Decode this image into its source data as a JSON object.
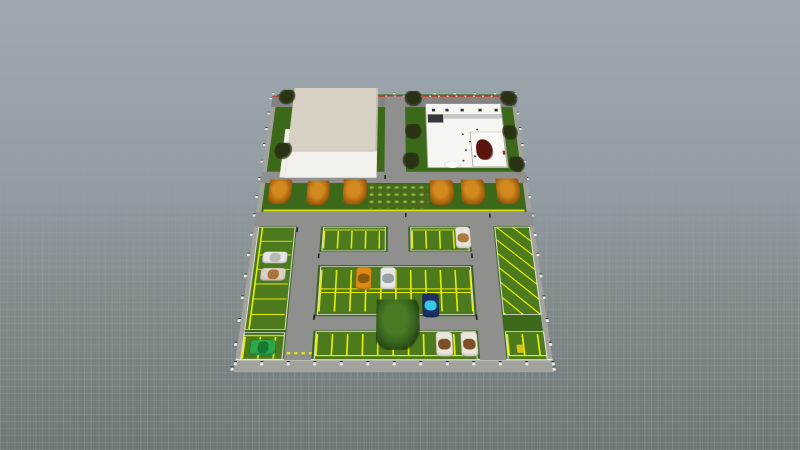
{
  "app": {
    "background_top": "#9ea8af",
    "background_bottom": "#6e7577",
    "grid_color": "#cdd7dc"
  },
  "scene": {
    "site": {
      "anchor_x": 394,
      "anchor_y": 214,
      "plan_width": 552,
      "plan_height": 948,
      "perspective_px": 1400,
      "tilt_deg": 55,
      "plan_scale": 0.5
    },
    "palette": {
      "grass": "#3c681a",
      "lot_green": "#4c7a1d",
      "stall_yellow": "#e8ec00",
      "road_gray": "#8f8f8d",
      "curb_red": "#b5463c",
      "roof_cream": "#d7d1c3",
      "building_white": "#f5f5f1",
      "tree_orange": "#d28a1e",
      "tree_green": "#35611c"
    },
    "objects": [
      {
        "n": "site-ground",
        "c": "grass-base",
        "b": [
          0,
          0,
          552,
          948
        ]
      },
      {
        "n": "sidewalk-left",
        "c": "walk",
        "b": [
          0,
          0,
          10,
          948
        ]
      },
      {
        "n": "sidewalk-right",
        "c": "walk",
        "b": [
          542,
          0,
          10,
          948
        ]
      },
      {
        "n": "sidewalk-bottom",
        "c": "walk",
        "b": [
          0,
          917,
          552,
          31
        ]
      },
      {
        "n": "curb-bottom",
        "c": "curb-white",
        "b": [
          0,
          914,
          552,
          4
        ]
      },
      {
        "n": "fence-top",
        "c": "fence",
        "x": -2,
        "y": -12,
        "dx": 46,
        "dy": 0,
        "count": 13
      },
      {
        "n": "fence-bottom",
        "c": "fence",
        "x": -2,
        "y": 920,
        "dx": 46,
        "dy": 0,
        "count": 13
      },
      {
        "n": "fence-left",
        "c": "fence",
        "x": -6,
        "y": 10,
        "dx": 0,
        "dy": 66,
        "count": 15
      },
      {
        "n": "fence-right",
        "c": "fence",
        "x": 550,
        "y": 10,
        "dx": 0,
        "dy": 66,
        "count": 15
      },
      {
        "n": "street-top",
        "c": "road road-top",
        "b": [
          0,
          8,
          552,
          48
        ]
      },
      {
        "n": "curb-red-top",
        "c": "curb-red",
        "b": [
          0,
          4,
          552,
          7
        ]
      },
      {
        "n": "driveway-between-buildings",
        "c": "road",
        "b": [
          256,
          8,
          45,
          354
        ]
      },
      {
        "n": "road-below-buildings",
        "c": "road",
        "b": [
          0,
          320,
          552,
          42
        ]
      },
      {
        "n": "road-main",
        "c": "road",
        "b": [
          0,
          466,
          552,
          51
        ]
      },
      {
        "n": "curb-yellow-strip",
        "c": "curb-yellow",
        "b": [
          14,
          458,
          524,
          7
        ]
      },
      {
        "n": "road-left-vertical",
        "c": "road",
        "b": [
          84,
          466,
          48,
          451
        ]
      },
      {
        "n": "road-mid-vertical",
        "c": "road",
        "b": [
          264,
          466,
          40,
          177
        ]
      },
      {
        "n": "road-right-vertical",
        "c": "road",
        "b": [
          426,
          466,
          46,
          451
        ]
      },
      {
        "n": "road-aisle-1",
        "c": "road",
        "b": [
          84,
          601,
          388,
          42
        ]
      },
      {
        "n": "road-aisle-2",
        "c": "road",
        "b": [
          84,
          797,
          388,
          40
        ]
      },
      {
        "n": "lot-left-column",
        "c": "lot stalls-h",
        "b": [
          8,
          519,
          74,
          316
        ]
      },
      {
        "n": "lot-row1-left",
        "c": "lot stalls-v",
        "b": [
          136,
          519,
          124,
          80
        ]
      },
      {
        "n": "lot-row1-right",
        "c": "lot stalls-v",
        "b": [
          308,
          519,
          114,
          80
        ]
      },
      {
        "n": "lot-double-row",
        "c": "lot stalls-double",
        "b": [
          136,
          647,
          286,
          146
        ]
      },
      {
        "n": "lot-row3",
        "c": "lot stalls-v-up",
        "b": [
          136,
          839,
          286,
          78
        ]
      },
      {
        "n": "lot-right-angled",
        "c": "lot stalls-angled",
        "b": [
          474,
          519,
          70,
          274
        ]
      },
      {
        "n": "lot-right-bottom",
        "c": "lot stalls-v-up",
        "b": [
          474,
          839,
          70,
          78
        ]
      },
      {
        "n": "lot-left-bottom",
        "c": "lot stalls-v",
        "b": [
          8,
          842,
          74,
          74
        ]
      },
      {
        "n": "entrance-dashes",
        "c": "dash-yellow",
        "b": [
          88,
          896,
          44,
          6
        ]
      },
      {
        "n": "shrub-bed",
        "c": "shrubs",
        "b": [
          222,
          366,
          124,
          88
        ]
      },
      {
        "n": "left-building-side",
        "c": "bldg-tier",
        "b": [
          38,
          150,
          12,
          192
        ]
      },
      {
        "n": "left-building-lower",
        "c": "bldg-tier",
        "b": [
          48,
          241,
          192,
          102
        ],
        "i": 1
      },
      {
        "n": "left-building-roof",
        "c": "bldg-roof",
        "b": [
          48,
          -31,
          192,
          272
        ],
        "i": 1
      },
      {
        "n": "right-building",
        "c": "bldg-right",
        "b": [
          346,
          40,
          171,
          265
        ],
        "i": 1
      },
      {
        "n": "right-building-band",
        "c": "band-gray",
        "b": [
          351,
          86,
          164,
          20
        ]
      },
      {
        "n": "right-building-panel",
        "c": "panel-dark",
        "b": [
          351,
          88,
          34,
          34
        ]
      },
      {
        "n": "roof-unit",
        "c": "unit-dark",
        "b": [
          360,
          62,
          9,
          13
        ]
      },
      {
        "n": "roof-unit",
        "c": "unit-dark",
        "b": [
          390,
          62,
          9,
          13
        ]
      },
      {
        "n": "roof-unit",
        "c": "unit-dark",
        "b": [
          424,
          62,
          9,
          13
        ]
      },
      {
        "n": "roof-unit",
        "c": "unit-dark",
        "b": [
          464,
          62,
          9,
          13
        ]
      },
      {
        "n": "roof-unit",
        "c": "unit-dark",
        "b": [
          500,
          62,
          9,
          13
        ]
      },
      {
        "n": "right-building-room",
        "c": "room",
        "b": [
          441,
          161,
          74,
          140
        ]
      },
      {
        "n": "room-furniture-red",
        "c": "blob-red",
        "b": [
          452,
          192,
          34,
          80
        ]
      },
      {
        "n": "interior-item",
        "c": "dot-dark",
        "b": [
          424,
          168,
          4,
          7
        ]
      },
      {
        "n": "interior-item",
        "c": "dot-dark",
        "b": [
          438,
          198,
          4,
          7
        ]
      },
      {
        "n": "interior-item",
        "c": "dot-dark",
        "b": [
          428,
          232,
          4,
          7
        ]
      },
      {
        "n": "interior-item",
        "c": "dot-dark",
        "b": [
          446,
          256,
          4,
          7
        ]
      },
      {
        "n": "interior-item",
        "c": "dot-dark",
        "b": [
          421,
          274,
          4,
          7
        ]
      },
      {
        "n": "interior-item",
        "c": "dot-dark",
        "b": [
          456,
          148,
          4,
          7
        ]
      },
      {
        "n": "right-building-door",
        "c": "door-red",
        "b": [
          508,
          238,
          5,
          16
        ]
      },
      {
        "n": "entrance-canopy",
        "c": "entrance",
        "b": [
          382,
          280,
          34,
          26
        ]
      },
      {
        "n": "yellow-cart",
        "c": "obj-yellow",
        "b": [
          492,
          876,
          12,
          22
        ]
      },
      {
        "n": "car-white-left",
        "c": "car",
        "o": "h",
        "b": [
          24,
          600,
          48,
          38
        ],
        "body": "#e6e6e2",
        "roof": "#b9b9b4",
        "i": 1
      },
      {
        "n": "car-tan-left",
        "c": "car",
        "o": "h",
        "b": [
          24,
          652,
          48,
          40
        ],
        "body": "#d9d2c2",
        "roof": "#a8743c",
        "i": 1
      },
      {
        "n": "car-orange",
        "c": "car",
        "b": [
          204,
          650,
          30,
          68
        ],
        "body": "#e08a14",
        "roof": "#8a5a0e",
        "i": 1
      },
      {
        "n": "car-white-mid",
        "c": "car",
        "b": [
          250,
          650,
          30,
          68
        ],
        "body": "#e9e9e5",
        "roof": "#9aa0a6",
        "i": 1
      },
      {
        "n": "car-blue",
        "c": "car",
        "b": [
          328,
          730,
          30,
          70
        ],
        "body": "#1d2f63",
        "roof": "#35c8e8",
        "i": 1
      },
      {
        "n": "car-green",
        "c": "car",
        "o": "h",
        "b": [
          22,
          862,
          46,
          42
        ],
        "body": "#2da74a",
        "roof": "#157a30",
        "i": 1
      },
      {
        "n": "car-white-brown-1",
        "c": "car",
        "b": [
          350,
          840,
          30,
          68
        ],
        "body": "#eae6dc",
        "roof": "#7c5026",
        "i": 1
      },
      {
        "n": "car-white-brown-2",
        "c": "car",
        "b": [
          394,
          840,
          30,
          68
        ],
        "body": "#eae6dc",
        "roof": "#7c5026",
        "i": 1
      },
      {
        "n": "car-white-tan-topright",
        "c": "car",
        "b": [
          396,
          518,
          30,
          72
        ],
        "body": "#e8e4da",
        "roof": "#a97c3e",
        "i": 1
      },
      {
        "n": "light-pole",
        "c": "pole",
        "b": [
          298,
          470,
          3,
          15
        ]
      },
      {
        "n": "light-pole",
        "c": "pole",
        "b": [
          466,
          472,
          3,
          15
        ]
      },
      {
        "n": "light-pole",
        "c": "pole",
        "b": [
          130,
          606,
          3,
          15
        ]
      },
      {
        "n": "light-pole",
        "c": "pole",
        "b": [
          424,
          606,
          3,
          15
        ]
      },
      {
        "n": "light-pole",
        "c": "pole",
        "b": [
          130,
          792,
          3,
          15
        ]
      },
      {
        "n": "light-pole",
        "c": "pole",
        "b": [
          424,
          792,
          3,
          15
        ]
      },
      {
        "n": "light-pole",
        "c": "pole",
        "b": [
          84,
          520,
          3,
          15
        ]
      },
      {
        "n": "light-pole",
        "c": "pole",
        "b": [
          256,
          332,
          3,
          15
        ]
      },
      {
        "n": "tree-bare",
        "c": "tree-bare",
        "b": [
          14,
          -22,
          38,
          66
        ],
        "i": 1
      },
      {
        "n": "tree-bare",
        "c": "tree-bare",
        "b": [
          300,
          -16,
          40,
          68
        ],
        "i": 1
      },
      {
        "n": "tree-bare",
        "c": "tree-bare",
        "b": [
          516,
          -16,
          40,
          68
        ],
        "i": 1
      },
      {
        "n": "tree-bare",
        "c": "tree-bare",
        "b": [
          20,
          206,
          38,
          66
        ],
        "i": 1
      },
      {
        "n": "tree-bare",
        "c": "tree-bare",
        "b": [
          300,
          128,
          36,
          64
        ],
        "i": 1
      },
      {
        "n": "tree-bare",
        "c": "tree-bare",
        "b": [
          294,
          246,
          36,
          64
        ],
        "i": 1
      },
      {
        "n": "tree-bare",
        "c": "tree-bare",
        "b": [
          512,
          134,
          34,
          60
        ],
        "i": 1
      },
      {
        "n": "tree-bare",
        "c": "tree-bare",
        "b": [
          518,
          262,
          34,
          60
        ],
        "i": 1
      },
      {
        "n": "tree-autumn",
        "c": "tree-orange",
        "b": [
          20,
          350,
          46,
          88
        ],
        "i": 1
      },
      {
        "n": "tree-autumn",
        "c": "tree-orange",
        "b": [
          98,
          354,
          46,
          88
        ],
        "i": 1
      },
      {
        "n": "tree-autumn",
        "c": "tree-orange",
        "b": [
          172,
          348,
          48,
          92
        ],
        "i": 1
      },
      {
        "n": "tree-autumn",
        "c": "tree-orange",
        "b": [
          350,
          352,
          48,
          90
        ],
        "i": 1
      },
      {
        "n": "tree-autumn",
        "c": "tree-orange",
        "b": [
          414,
          350,
          48,
          90
        ],
        "i": 1
      },
      {
        "n": "tree-autumn",
        "c": "tree-orange",
        "b": [
          486,
          346,
          48,
          92
        ],
        "i": 1
      },
      {
        "n": "tree-big-green",
        "c": "tree-green",
        "b": [
          244,
          748,
          78,
          142
        ],
        "i": 1
      }
    ]
  }
}
